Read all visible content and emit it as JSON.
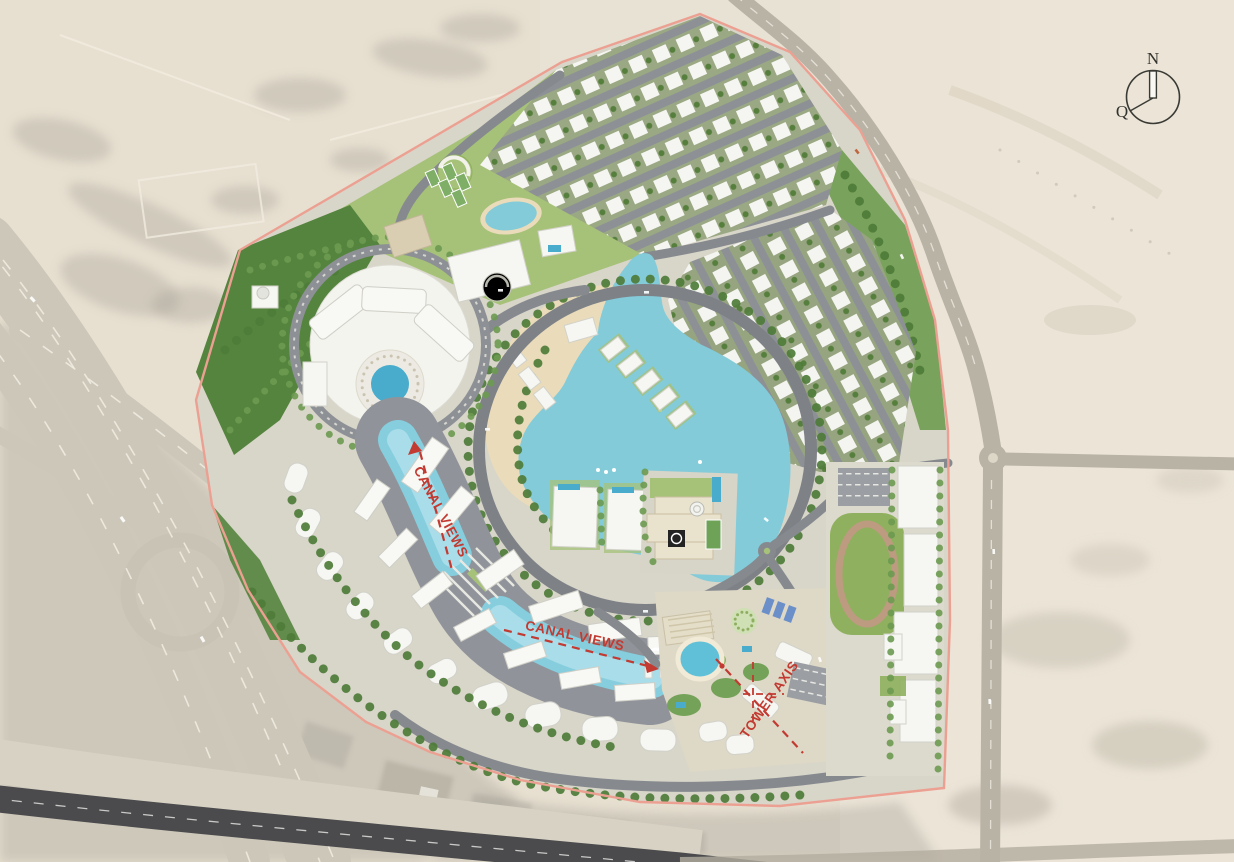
{
  "compass": {
    "north": "N",
    "qibla": "Q"
  },
  "annotations": {
    "canal_views_upper": "CANAL VIEWS",
    "canal_views_lower": "CANAL VIEWS",
    "tower_axis": "TOWER AXIS"
  },
  "colors": {
    "desert": "#e7e0d1",
    "desert_light": "#ece6d8",
    "desert_shadow": "#8f8c82",
    "highway": "#cdc7ba",
    "highway_dark": "#4b4b4d",
    "road": "#868a8f",
    "greenery": "#6f9c50",
    "forest": "#55843e",
    "lawn": "#a6c178",
    "lagoon": "#83cbd9",
    "canal": "#86cede",
    "pool": "#49accd",
    "beach": "#eadcba",
    "building": "#f6f6f2",
    "boundary": "#eca092",
    "annotation_red": "#c23a31",
    "track": "#bd9b80"
  }
}
